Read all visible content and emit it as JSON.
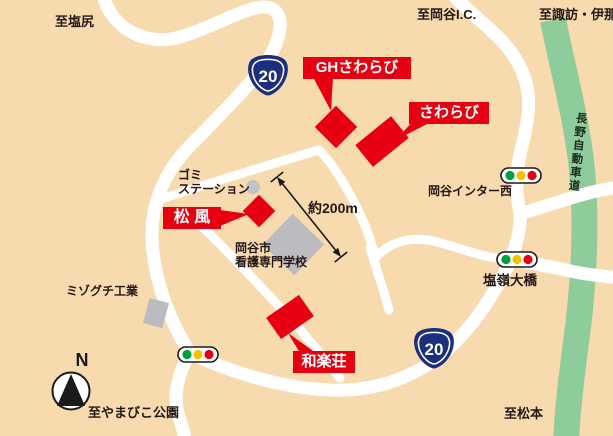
{
  "title": "施設案内地図",
  "destinations": {
    "shiojiri": "至塩尻",
    "okaya_ic": "至岡谷I.C.",
    "suwa_ina": "至諏訪・伊那",
    "yamabiko_park": "至やまびこ公園",
    "matsumoto": "至松本"
  },
  "facilities": {
    "gh_sawarabi": "GHさわらび",
    "sawarabi": "さわらび",
    "matsukaze": "松 風",
    "warakuso": "和楽荘"
  },
  "places": {
    "gomi_station": {
      "line1": "ゴミ",
      "line2": "ステーション"
    },
    "okaya_inter_west": "岡谷インター西",
    "nursing_school": {
      "line1": "岡谷市",
      "line2": "看護専門学校"
    },
    "mizoguchi": "ミゾグチ工業",
    "enrei_bridge": "塩嶺大橋"
  },
  "expressway": {
    "name": "長野自動車道"
  },
  "route": {
    "shield1": "20",
    "shield2": "20"
  },
  "distance": {
    "label": "約200m"
  },
  "compass": {
    "label": "N"
  },
  "colors": {
    "background": "#F7DAAE",
    "road": "#FFFFFF",
    "expressway_green": "#8FCC9C",
    "accent_red": "#E60012",
    "building_gray": "#BCBCC0",
    "shield_navy": "#1D2E7E",
    "signal_green": "#00A040",
    "signal_yellow": "#F5C200",
    "signal_red": "#E60012",
    "text_black": "#231815"
  }
}
